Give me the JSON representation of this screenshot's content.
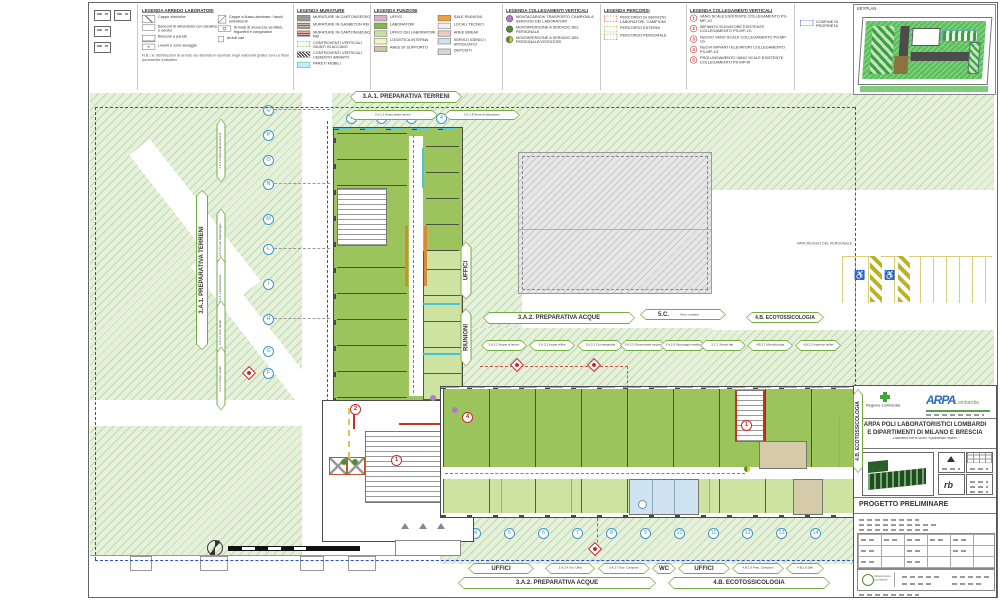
{
  "legend_arredo": {
    "title": "LEGENDA ARREDO LABORATORI",
    "items": [
      "Cappe chimiche",
      "Banconi di laboratorio con alzatina e servizi",
      "Banconi a parete",
      "Lavelli e zone lavaggio",
      "Cappe a flusso laminare / tavoli antivibranti",
      "Armadi di sicurezza ventilati, frigoriferi e congelatori",
      "Arredi vari"
    ],
    "note": "N.B.: le distribuzioni di arredo dei laboratori riportate negli elaborati grafici sono a titolo puramente indicativo"
  },
  "legend_murature": {
    "title": "LEGENDA MURATURE",
    "items": [
      {
        "label": "MURATURE IN CARTONGESSO",
        "color": "#9a9a9a"
      },
      {
        "label": "MURATURE IN GASBETON REI",
        "color": "#8a6b4f"
      },
      {
        "label": "MURATURE IN CARTONGESSO REI",
        "color": "#c0392b"
      },
      {
        "label": "CONTROVENTI VERTICALI GIUNTI IN ACCIAIO",
        "color": "#6aa84f"
      },
      {
        "label": "CONTROVENTI VERTICALI CEMENTO ARMATO",
        "color": "#222222"
      },
      {
        "label": "PARETI MOBILI",
        "color": "#7fd8e8"
      }
    ]
  },
  "legend_funzioni": {
    "title": "LEGENDA FUNZIONI",
    "items": [
      {
        "label": "UFFICI",
        "color": "#d9b3cb"
      },
      {
        "label": "LABORATORI",
        "color": "#7fbb4e"
      },
      {
        "label": "UFFICI DEI LABORATORI",
        "color": "#c6e0a0"
      },
      {
        "label": "LOGISTICA INTERNA",
        "color": "#f6f4bc"
      },
      {
        "label": "AREE DI SUPPORTO",
        "color": "#cfc6a4"
      },
      {
        "label": "SALE RIUNIONI",
        "color": "#f0a13a"
      },
      {
        "label": "LOCALI TECNICI",
        "color": "#f1f1f1"
      },
      {
        "label": "AREE BREAK",
        "color": "#ecc9c0"
      },
      {
        "label": "SERVIZI IGENICI / SPOGLIATOI",
        "color": "#cfe2ee"
      },
      {
        "label": "DEPOSITI",
        "color": "#d6d6d6"
      }
    ]
  },
  "legend_collegamenti1": {
    "title": "LEGENDA COLLEGAMENTI VERTICALI",
    "items": [
      {
        "label": "MONTACARICHI TRASPORTO CAMPIONI A SERVIZIO DEI LABORATORI",
        "color": "#b07cc6"
      },
      {
        "label": "MONTAPERSONE A SERVIZIO DEL PERSONALE",
        "color": "#4e8f2f"
      },
      {
        "label": "MONTAPERSONE A SERVIZIO DEL PERSONALE/VISITATORI",
        "color": "#4e8f2f",
        "color2": "#d8c62f"
      }
    ]
  },
  "legend_percorsi": {
    "title": "LEGENDA PERCORSI",
    "items": [
      {
        "label": "PERCORSO DI SERVIZIO LABORATORI, CAMPIONI",
        "color": "#d4524a"
      },
      {
        "label": "PERCORSO ESTERNI",
        "color": "#d6ca4e"
      },
      {
        "label": "PERCORSO PERSONALE",
        "color": "#5f9e3d"
      }
    ]
  },
  "legend_collegamenti2": {
    "title": "LEGENDA COLLEGAMENTI VERTICALI",
    "items": [
      {
        "num": "1",
        "label": "VANO SCALE ESISTENTE COLLEGAMENTO PS-MP-1G"
      },
      {
        "num": "2",
        "label": "IMPIANTO ELEVATORE ESISTENTE COLLEGAMENTO PS-MP-1G"
      },
      {
        "num": "3",
        "label": "NUOVO VANO SCALE COLLEGAMENTO PS-MP-1G"
      },
      {
        "num": "4",
        "label": "NUOVI IMPIANTI ELEVATORI COLLEGAMENTO PS-MP-1G"
      },
      {
        "num": "5",
        "label": "PROLUNGAMENTO VANO SCALE ESISTENTE COLLEGAMENTO PS-MP-RI"
      }
    ]
  },
  "confine_label": "CONFINE DI PROPRIETA'",
  "keyplan_title": "KEYPLAN",
  "plan": {
    "labels": {
      "prep_terreni": "3.A.1. PREPARATIVA TERRENI",
      "prep_acque": "3.A.2. PREPARATIVA ACQUE",
      "sc": "5.C.",
      "sc_extra": "Serv. comuni",
      "ecotossicologia": "4.B. ECOTOSSICOLOGIA",
      "uffici": "UFFICI",
      "riunioni": "RIUNIONI",
      "wc": "WC",
      "parcheggio": "PARCHEGGIO DEL PERSONALE"
    },
    "small_labels_top": [
      "3.A.1.2 Sottocolture terreni",
      "3.A.1.8 Serre di laboratorio"
    ],
    "small_labels_left": [
      "3.A.1.2 Sottocolture terreni",
      "3.A.1.5 Lab. batteriologia",
      "3.A.1.1 Essiccazione",
      "3.A.1.7 Estr. liquidi",
      "3.A.1.4 Prep. eluati"
    ],
    "small_labels_mid": [
      "3.A.2.2 Acque di lavoro",
      "3.A.2.1 Acque reflue",
      "3.A.2.3 Cromatografia",
      "3.A.2.5 Strumentale acque",
      "3.A.2.8 Stoccaggio reattivi",
      "5.C.1 Servizi lab.",
      "4.B.2.1 Microbiologia",
      "4.B.2.2 Ingresso buffer"
    ],
    "small_labels_bottom": [
      "3.A.2.4 Um. Uffici",
      "3.A.2.7 Estr. Campioni",
      "4.B.1.6 Prep. Campioni",
      "4.B.1.5 Diffr."
    ],
    "grid_letters": [
      "Q",
      "P",
      "O",
      "N",
      "M",
      "L",
      "I",
      "H",
      "G",
      "F"
    ],
    "grid_numbers": [
      "1",
      "2",
      "3",
      "4",
      "5",
      "6",
      "7",
      "8",
      "9",
      "10",
      "11",
      "12",
      "13",
      "14"
    ],
    "top_numbers": [
      "1",
      "2",
      "3",
      "4"
    ],
    "lift_badges": [
      "2",
      "1",
      "4",
      "1"
    ]
  },
  "titleblock": {
    "region_logo": "Regione Lombardia",
    "arpa": "ARPA",
    "arpa_sub": "Lombardia",
    "title1": "ARPA POLI LABORATORISTICI LOMBARDI",
    "title2": "E DIPARTIMENTI DI MILANO E BRESCIA",
    "subtitle": "Laboratori ARPA MI/BS «Qualificati» Milano",
    "phase": "PROGETTO PRELIMINARE",
    "rb": "rb",
    "infra": "Infrastrutture Lombarde"
  }
}
